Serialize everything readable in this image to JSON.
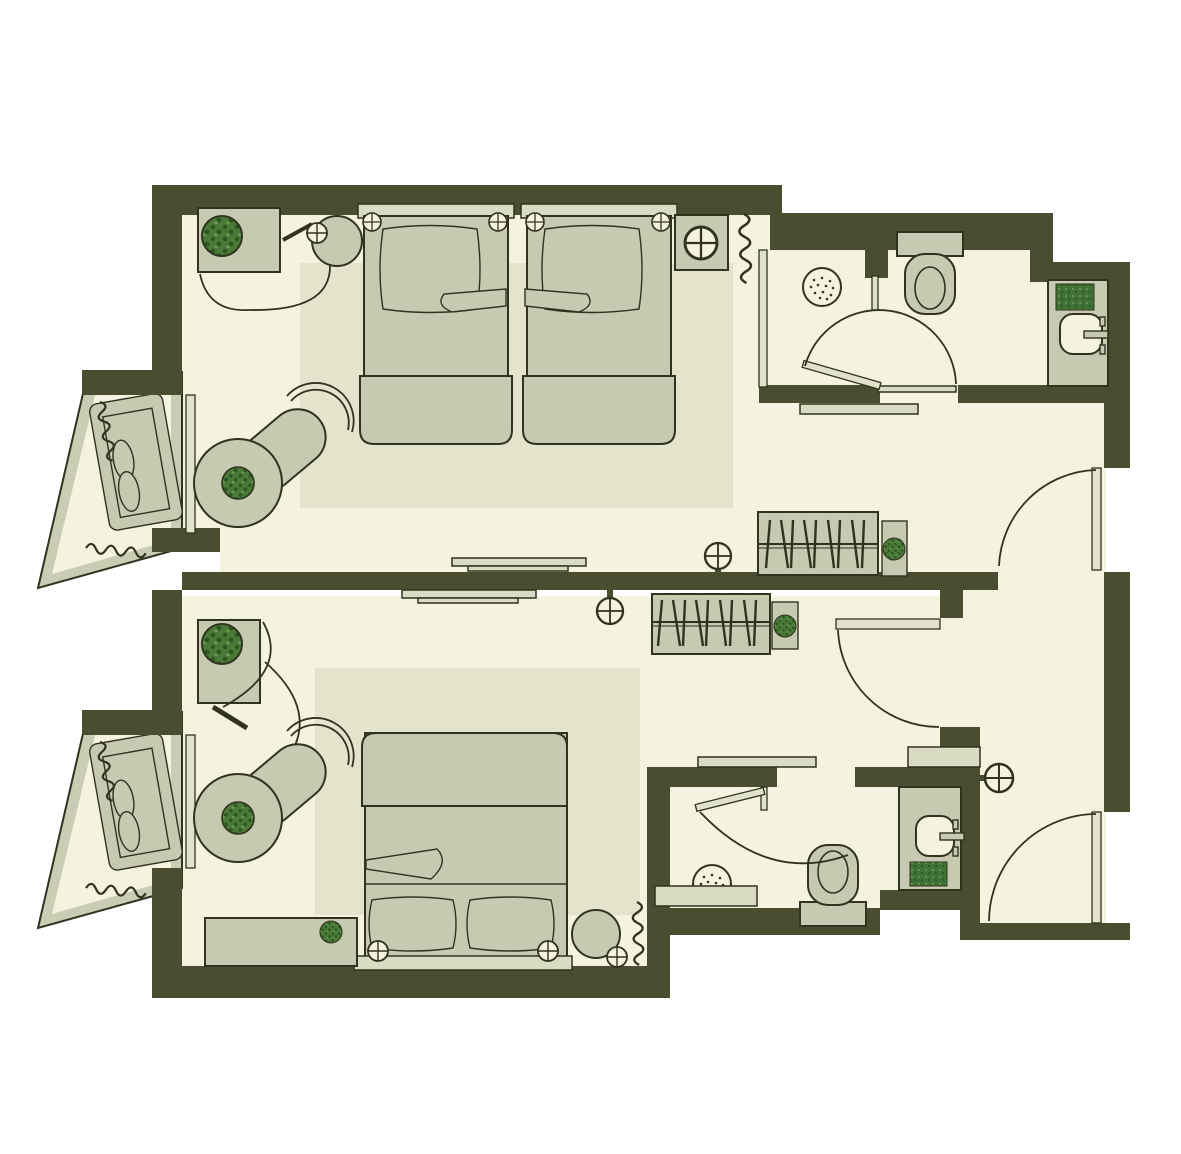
{
  "meta": {
    "type": "floor-plan",
    "subject": "two-hotel-room-suite-top-view",
    "units_shown": "none",
    "text_labels": []
  },
  "colors": {
    "white": "#ffffff",
    "wall": "#4a4e31",
    "floor": "#f5f2df",
    "sage": "#c6cab1",
    "sageLight": "#d9dcc3",
    "rug": "#e4e3cc",
    "glass": "#e0e2ca",
    "balconyBand": "#c9cdb3",
    "outline": "#30331e",
    "plant": "#4a7a38",
    "plantDark": "#2c5722",
    "plantLite": "#6f9c58",
    "towel": "#3f7234"
  },
  "rooms": {
    "room_top": {
      "name": "twin-bedroom",
      "furniture": [
        "desk",
        "desk-plant",
        "desk-chair",
        "chair-lamp",
        "curtain-swags",
        "twin-bed-1",
        "twin-bed-2",
        "bed-corner-lamps",
        "nightstand",
        "nightstand-lamp",
        "window-curtain-coil",
        "area-rug",
        "lounge-chair",
        "round-side-table",
        "table-plant",
        "wall-tv",
        "wall-lamp",
        "wardrobe-with-hangers",
        "plant-stand",
        "luggage-shelf"
      ]
    },
    "bathroom_top": {
      "name": "bathroom-1",
      "fixtures": [
        "shower-head",
        "glass-partition",
        "toilet",
        "swing-door",
        "vanity-counter",
        "sink",
        "faucet",
        "towel",
        "door-sill"
      ]
    },
    "balcony_top": {
      "name": "balcony-1",
      "furniture": [
        "lounge-bed",
        "pillows",
        "curtain-coils"
      ]
    },
    "vestibule_top": {
      "name": "entry-1",
      "fixtures": [
        "entrance-door",
        "door-swing-arc"
      ]
    },
    "room_bottom": {
      "name": "double-bedroom",
      "furniture": [
        "desk",
        "desk-plant",
        "curtain-swags",
        "double-bed",
        "bed-pillows",
        "bed-corner-lamps",
        "headboard",
        "bench",
        "bench-plant",
        "round-stool",
        "stool-lamp",
        "window-curtain-coil",
        "area-rug",
        "lounge-chair",
        "round-side-table",
        "table-plant",
        "wall-tv",
        "wall-lamp",
        "wardrobe-with-hangers",
        "plant-stand",
        "interior-door",
        "entry-shelf",
        "entry-lamp"
      ]
    },
    "bathroom_bottom": {
      "name": "bathroom-2",
      "fixtures": [
        "shower-head",
        "shower-bench",
        "glass-partition",
        "toilet",
        "swing-door",
        "vanity-counter",
        "sink",
        "faucet",
        "towel",
        "top-shelf"
      ]
    },
    "balcony_bottom": {
      "name": "balcony-2",
      "furniture": [
        "lounge-bed",
        "pillows",
        "curtain-coils"
      ]
    },
    "vestibule_bottom": {
      "name": "entry-2",
      "fixtures": [
        "entrance-door",
        "door-swing-arc"
      ]
    }
  }
}
